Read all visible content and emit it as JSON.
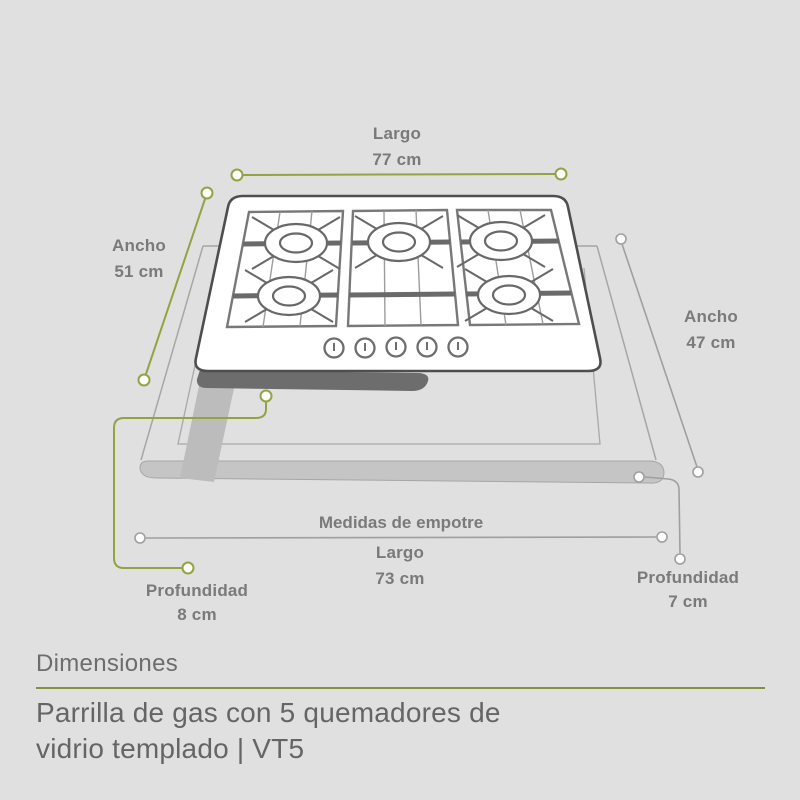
{
  "colors": {
    "background": "#e0e0e0",
    "accent_green": "#93a343",
    "label_gray": "#7a7a7a",
    "line_gray": "#9f9f9f",
    "title_gray": "#6d6d6d",
    "cooktop_outline": "#4e4e4e",
    "dark_body": "#6d6d6d",
    "counter_face": "#c5c5c5"
  },
  "illustration": {
    "type": "gas cooktop on countertop, isometric dimension diagram",
    "burner_count": 5,
    "knob_count": 5
  },
  "dimensions": {
    "top_length": {
      "label": "Largo",
      "value": "77 cm"
    },
    "left_width": {
      "label": "Ancho",
      "value": "51 cm"
    },
    "right_width": {
      "label": "Ancho",
      "value": "47 cm"
    },
    "cutout_header": "Medidas de empotre",
    "cutout_length": {
      "label": "Largo",
      "value": "73 cm"
    },
    "left_depth": {
      "label": "Profundidad",
      "value": "8 cm"
    },
    "right_depth": {
      "label": "Profundidad",
      "value": "7 cm"
    }
  },
  "footer": {
    "section_title": "Dimensiones",
    "product_name_line1": "Parrilla de gas con 5 quemadores de",
    "product_name_line2": "vidrio templado | VT5"
  }
}
